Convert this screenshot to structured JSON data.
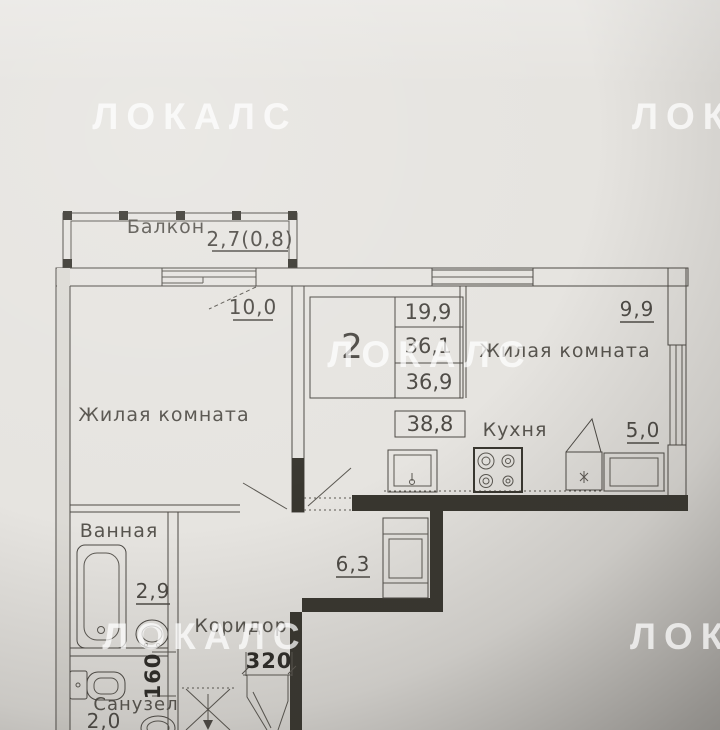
{
  "watermark": {
    "text": "ЛОКАЛС"
  },
  "rooms": {
    "balcony": {
      "name": "Балкон",
      "area": "2,7(0,8)"
    },
    "living_left": {
      "name": "Жилая комната",
      "area": "10,0"
    },
    "living_right": {
      "name": "Жилая комната",
      "area": "9,9"
    },
    "kitchen": {
      "name": "Кухня",
      "area": "5,0"
    },
    "bathroom": {
      "name": "Ванная",
      "area": "2,9"
    },
    "corridor": {
      "name": "Коридор",
      "area": "6,3"
    },
    "wc": {
      "name": "Санузел",
      "area": "2,0"
    }
  },
  "summary": {
    "rooms_count": "2",
    "living_area": "19,9",
    "area_row2": "36,1",
    "area_row3": "36,9",
    "total_area": "38,8"
  },
  "dimensions": {
    "entry_width": "320",
    "wall_width": "160"
  },
  "colors": {
    "paper": "#e6e4e0",
    "ink": "#4c4944",
    "wall_fill": "#38362f",
    "shadow": "#6e6c68"
  }
}
